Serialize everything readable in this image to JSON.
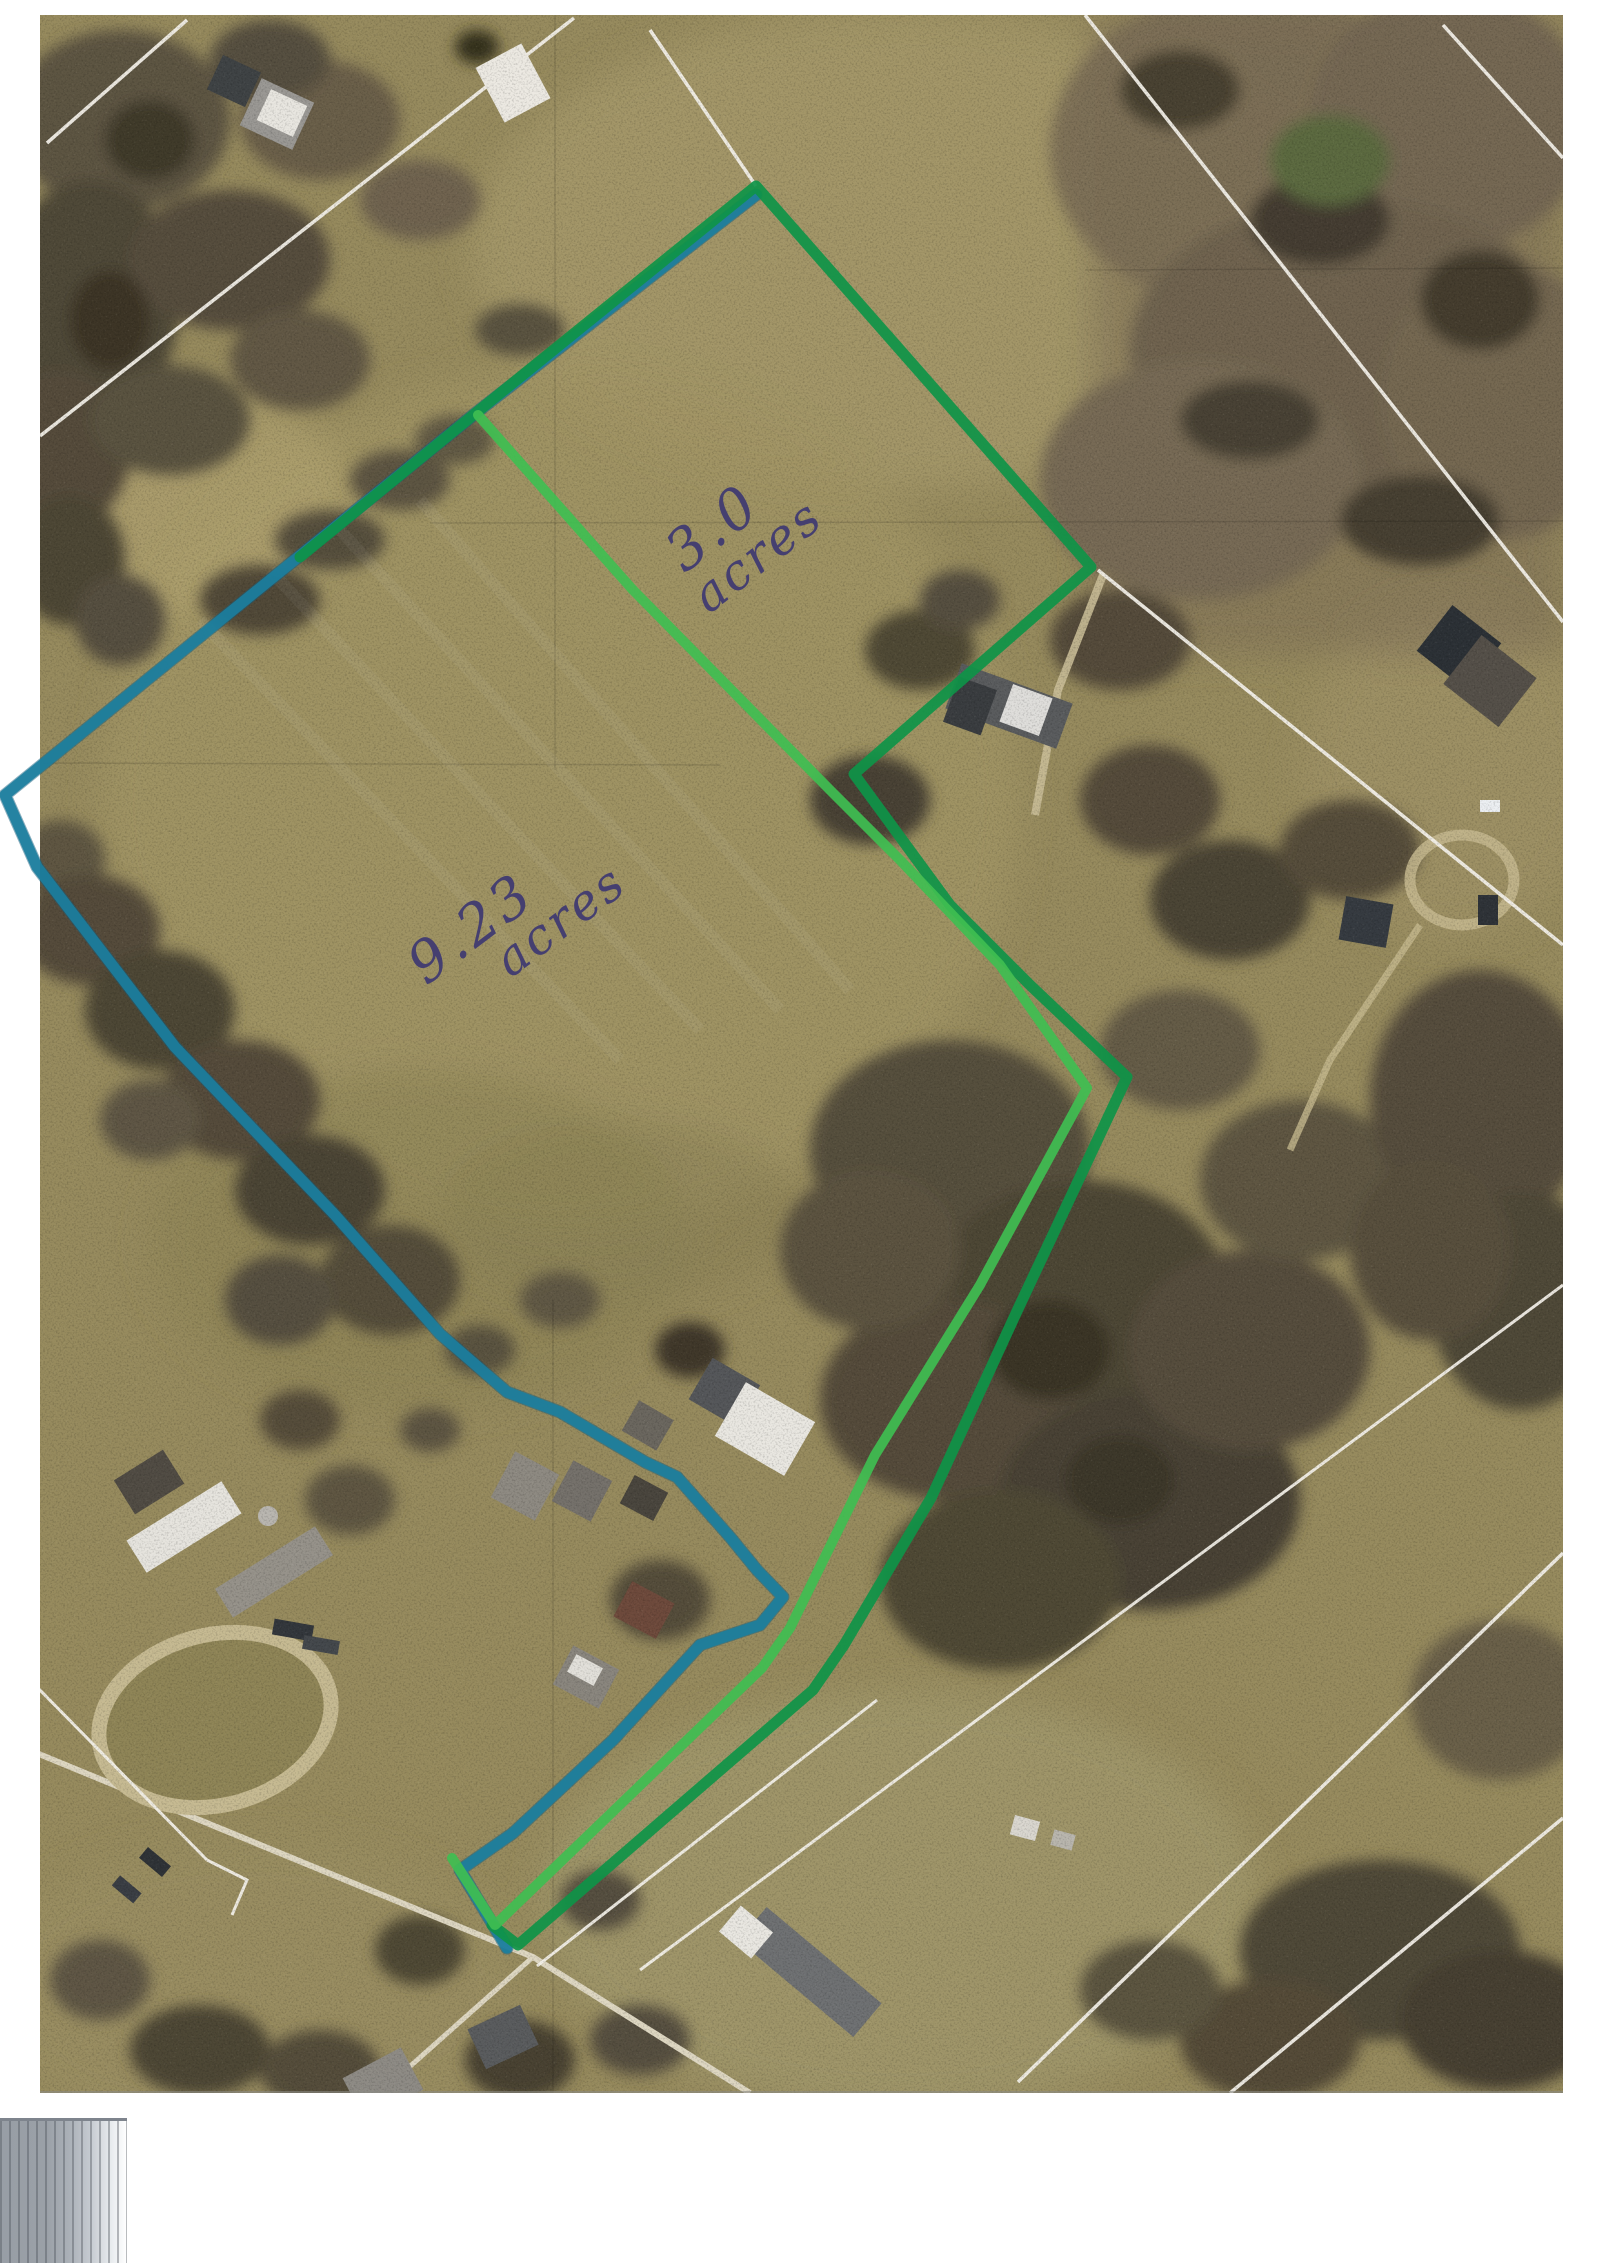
{
  "annotations": {
    "north_parcel": {
      "area": "3.0",
      "unit": "acres",
      "outline_color": "#0e9448",
      "divider_color": "#3fbe51"
    },
    "west_parcel": {
      "area": "9.23",
      "unit": "acres",
      "outline_color": "#1b7fa0"
    },
    "label_ink_color": "#453f70"
  }
}
